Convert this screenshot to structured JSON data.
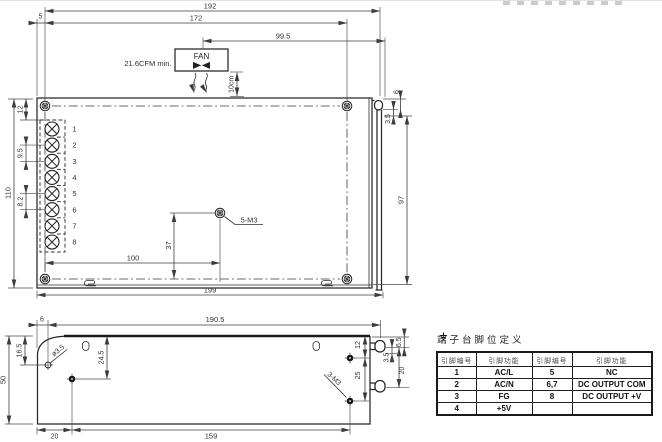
{
  "style": {
    "line_color": "#262626",
    "text_color": "#31313a",
    "background": "#ffffff"
  },
  "top_view": {
    "dims": {
      "overall_192": "192",
      "screws_172": "172",
      "fan_right_99_5": "99.5",
      "edge_5": "5",
      "top_12": "12",
      "pitch_9_5": "9.5",
      "pitch_8_2": "8.2",
      "height_110": "110",
      "bracket_97": "97",
      "bracket_3_5": "3.5",
      "bracket_6": "6",
      "hole_100": "100",
      "hole_37": "37",
      "total_199": "199"
    },
    "labels": {
      "fan": "FAN",
      "airflow": "21.6CFM min.",
      "clearance": "10cm",
      "mounting_holes": "5-M3"
    },
    "terminals": [
      "1",
      "2",
      "3",
      "4",
      "5",
      "6",
      "7",
      "8"
    ]
  },
  "side_view": {
    "dims": {
      "edge_6": "6",
      "overall_190_5": "190.5",
      "hole_16_5": "16.5",
      "height_50": "50",
      "hole_24_5": "24.5",
      "hole_dia": "ø3.5",
      "screw_12": "12",
      "screw_25": "25",
      "bottom_20": "20",
      "bottom_159": "159",
      "hook_6_5": "6.5",
      "hook_3_5": "3.5",
      "hook_20": "20"
    },
    "labels": {
      "mounting_holes": "3-M3"
    }
  },
  "pin_table": {
    "title": "端子台脚位定义",
    "headers": [
      "引脚编号",
      "引脚功能",
      "引脚编号",
      "引脚功能"
    ],
    "rows": [
      [
        "1",
        "AC/L",
        "5",
        "NC"
      ],
      [
        "2",
        "AC/N",
        "6,7",
        "DC OUTPUT COM"
      ],
      [
        "3",
        "FG",
        "8",
        "DC OUTPUT +V"
      ],
      [
        "4",
        "+5V",
        "",
        ""
      ]
    ]
  }
}
